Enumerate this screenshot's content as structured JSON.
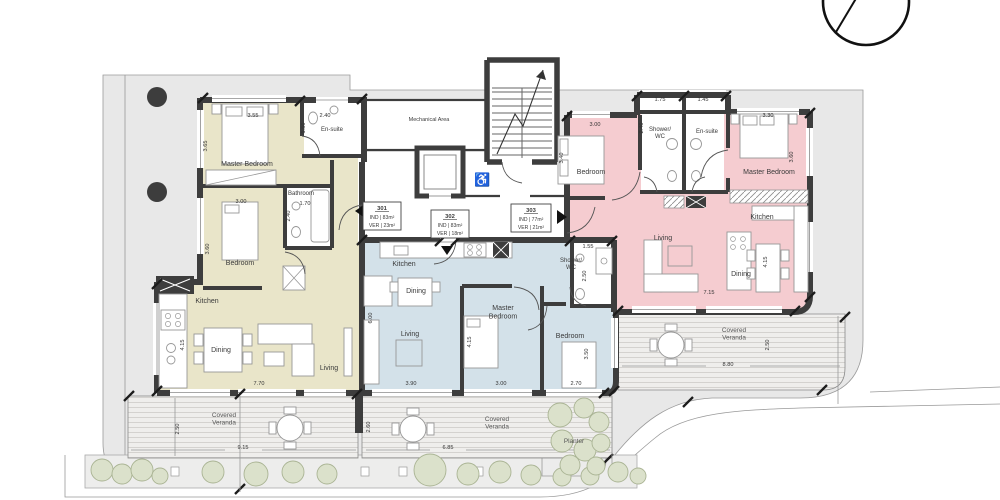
{
  "colors": {
    "wall": "#3d3d3d",
    "site": "#e8e8e8",
    "unit_301": "#e9e5c9",
    "unit_302": "#d3e1e9",
    "unit_303": "#f5ccd0",
    "bush_fill": "#dbe1cb",
    "bush_stroke": "#aab494"
  },
  "units": [
    {
      "number": "301",
      "rooms": {
        "master": "Master Bedroom",
        "ensuite": "En-suite",
        "bathroom": "Bathroom",
        "bedroom": "Bedroom",
        "kitchen": "Kitchen",
        "dining": "Dining",
        "living": "Living"
      },
      "dims": {
        "master_w": "3.55",
        "master_h": "3.65",
        "ensuite_w": "2.40",
        "ensuite_h": "1.50",
        "bathroom_w": "1.70",
        "bathroom_h": "2.40",
        "bedroom_w": "3.00",
        "bedroom_h": "3.60",
        "kitchen_h": "4.15",
        "living_w": "7.70"
      }
    },
    {
      "number": "302",
      "rooms": {
        "kitchen": "Kitchen",
        "dining": "Dining",
        "living": "Living",
        "master": "Master\nBedroom",
        "bedroom": "Bedroom",
        "shower": "Shower/\nWC"
      },
      "dims": {
        "living_h": "6.00",
        "living_w": "3.90",
        "master_w": "3.00",
        "master_h": "4.15",
        "bedroom_w": "2.70",
        "bedroom_h": "3.50",
        "shower_w": "1.55",
        "shower_h": "2.50"
      }
    },
    {
      "number": "303",
      "rooms": {
        "bedroom": "Bedroom",
        "shower": "Shower/\nWC",
        "ensuite": "En-suite",
        "master": "Master Bedroom",
        "kitchen": "Kitchen",
        "living": "Living",
        "dining": "Dining"
      },
      "dims": {
        "shower_w": "1.75",
        "ensuite_w": "1.45",
        "bedroom_w": "3.00",
        "bedroom_h": "3.40",
        "hall_h": "2.40",
        "master_w": "3.30",
        "master_h": "3.60",
        "living_w": "7.15",
        "kitchen_h": "4.15"
      }
    }
  ],
  "unit_boxes": [
    {
      "number": "301",
      "ind": "IND | 83m²",
      "ver": "VER | 23m²"
    },
    {
      "number": "302",
      "ind": "IND | 83m²",
      "ver": "VER | 18m²"
    },
    {
      "number": "303",
      "ind": "IND | 77m²",
      "ver": "VER | 21m²"
    }
  ],
  "core": {
    "mechanical": "Mechanical Area",
    "wheelchair_icon": "♿"
  },
  "verandas": [
    {
      "label": "Covered\nVeranda",
      "width": "9.15",
      "depth": "2.50"
    },
    {
      "label": "Covered\nVeranda",
      "width": "6.85",
      "depth": "2.60"
    },
    {
      "label": "Covered\nVeranda",
      "width": "8.80",
      "depth": "2.50"
    }
  ],
  "site": {
    "planter": "Planter"
  }
}
